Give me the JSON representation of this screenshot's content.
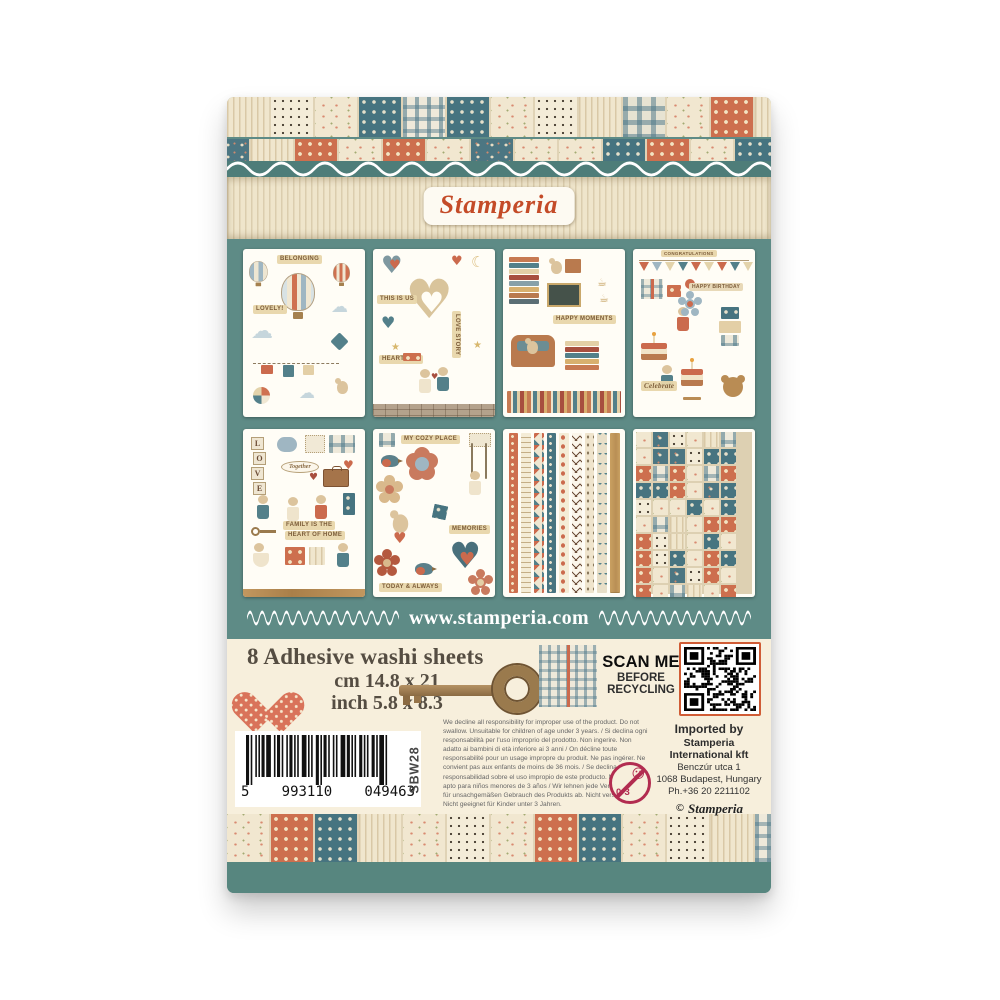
{
  "brand": {
    "logo": "Stamperia",
    "website": "www.stamperia.com"
  },
  "info": {
    "title": "8 Adhesive washi sheets",
    "size_cm": "cm 14.8 x 21",
    "size_inch": "inch 5.8 x 8.3"
  },
  "scan": {
    "line1": "SCAN ME",
    "line2": "BEFORE",
    "line3": "RECYCLING"
  },
  "legal": {
    "disclaimer": "We decline all responsibility for improper use of the product. Do not swallow. Unsuitable for children of age under 3 years. / Si declina ogni responsabilità per l'uso improprio del prodotto. Non ingerire. Non adatto ai bambini di età inferiore ai 3 anni / On décline toute responsabilité pour un usage impropre du produit. Ne pas ingérer. Ne convient pas aux enfants de moins de 36 mois. / Se declina toda responsabilidad sobre el uso impropio de este producto. No ingerir. No apto para niños menores de 3 años / Wir lehnen jede Verantwortung für unsachgemäßen Gebrauch des Produkts ab. Nicht verschlucken. Nicht geeignet für Kinder unter 3 Jahren.",
    "age_label": "0-3"
  },
  "importer": {
    "line1": "Imported by",
    "line2": "Stamperia International kft",
    "line3": "Benczúr utca 1",
    "line4": "1068 Budapest, Hungary",
    "line5": "Ph.+36 20 2211102",
    "copyright_mark": "©",
    "copyright_name": "Stamperia"
  },
  "barcode": {
    "prefix": "5",
    "group1": "993110",
    "group2": "049463",
    "sku": "SBW28"
  },
  "thumbnails": [
    {
      "name": "sheet-belonging",
      "labels": [
        "BELONGING",
        "LOVELY!"
      ]
    },
    {
      "name": "sheet-this-is-us",
      "labels": [
        "THIS IS US",
        "LOVE STORY",
        "HEARTFELT"
      ]
    },
    {
      "name": "sheet-happy-moments",
      "labels": [
        "HAPPY MOMENTS"
      ]
    },
    {
      "name": "sheet-celebrate",
      "labels": [
        "CONGRATULATIONS",
        "HAPPY BIRTHDAY",
        "Celebrate"
      ]
    },
    {
      "name": "sheet-family",
      "labels": [
        "Together",
        "FAMILY IS THE",
        "HEART OF HOME"
      ],
      "letters": [
        "L",
        "O",
        "V",
        "E"
      ]
    },
    {
      "name": "sheet-cozy-place",
      "labels": [
        "MY COZY PLACE",
        "MEMORIES",
        "TODAY & ALWAYS"
      ]
    },
    {
      "name": "sheet-washi-borders",
      "labels": []
    },
    {
      "name": "sheet-patchwork",
      "labels": []
    }
  ],
  "colors": {
    "teal_panel": "#5e8b86",
    "teal_band": "#4e7d79",
    "cream": "#f7efdc",
    "logo_red": "#c44b28",
    "orange": "#cd6f4e",
    "qr_border": "#d05c35",
    "age_symbol": "#b22c50"
  }
}
